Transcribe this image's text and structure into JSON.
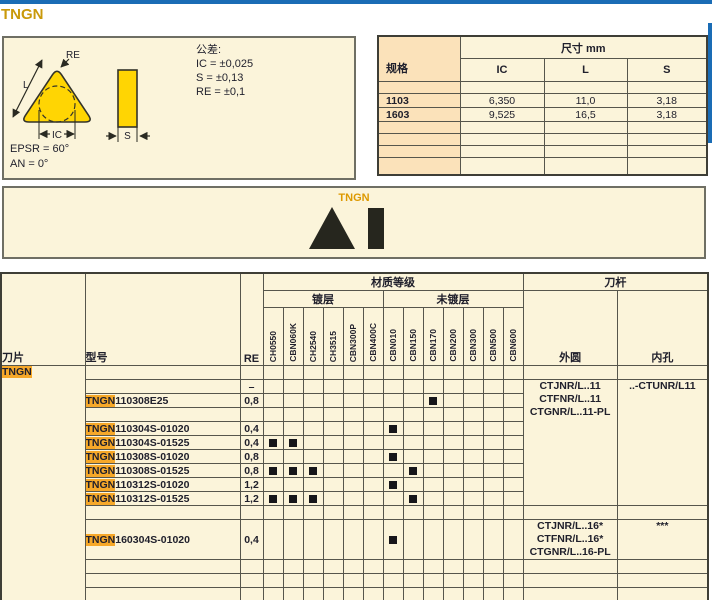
{
  "page": {
    "title": "TNGN",
    "accent_blue": "#1a6cb5",
    "cream": "#fbf4da",
    "peach": "#fbe2ba",
    "highlight_orange": "#f6a829",
    "insert_yellow": "#ffd503"
  },
  "diagram": {
    "labels": {
      "re": "RE",
      "l": "L",
      "ic": "IC",
      "s": "S"
    },
    "epsr": "EPSR = 60°",
    "an": "AN = 0°",
    "tolerance_title": "公差:",
    "tolerances": [
      "IC = ±0,025",
      "S = ±0,13",
      "RE = ±0,1"
    ]
  },
  "dims_table": {
    "spec_header": "规格",
    "size_header": "尺寸 mm",
    "columns": [
      "IC",
      "L",
      "S"
    ],
    "rows": [
      {
        "spec": "",
        "vals": [
          "",
          "",
          ""
        ]
      },
      {
        "spec": "1103",
        "vals": [
          "6,350",
          "11,0",
          "3,18"
        ]
      },
      {
        "spec": "1603",
        "vals": [
          "9,525",
          "16,5",
          "3,18"
        ]
      },
      {
        "spec": "",
        "vals": [
          "",
          "",
          ""
        ]
      },
      {
        "spec": "",
        "vals": [
          "",
          "",
          ""
        ]
      },
      {
        "spec": "",
        "vals": [
          "",
          "",
          ""
        ]
      },
      {
        "spec": "",
        "vals": [
          "",
          "",
          ""
        ]
      }
    ]
  },
  "shape_band": {
    "label": "TNGN"
  },
  "main_table": {
    "headers": {
      "blade": "刀片",
      "model": "型号",
      "re": "RE",
      "grade_group": "材质等级",
      "coated": "镀层",
      "uncoated": "未镀层",
      "holder_group": "刀杆",
      "od": "外圆",
      "id": "内孔"
    },
    "blade_label": "TNGN",
    "grade_columns": {
      "coated": [
        "CH0550",
        "CBN060K",
        "CH2540",
        "CH3515",
        "CBN300P",
        "CBN400C"
      ],
      "uncoated": [
        "CBN010",
        "CBN150",
        "CBN170",
        "CBN200",
        "CBN300",
        "CBN500",
        "CBN600"
      ]
    },
    "holder_blocks": {
      "block11": {
        "od": [
          "CTJNR/L..11",
          "CTFNR/L..11",
          "CTGNR/L..11-PL"
        ],
        "id": [
          "..-CTUNR/L11"
        ],
        "rowspan": 9
      },
      "block16": {
        "od": [
          "CTJNR/L..16*",
          "CTFNR/L..16*",
          "CTGNR/L..16-PL"
        ],
        "id": [
          "***"
        ],
        "rowspan": 1
      }
    },
    "rows": [
      {
        "model": "",
        "re": "",
        "marks": []
      },
      {
        "model": "",
        "re": "–",
        "marks": [],
        "holders": "block11"
      },
      {
        "model": "TNGN110308E25",
        "re": "0,8",
        "marks": [
          "CBN170"
        ],
        "in_merge": true
      },
      {
        "model": "",
        "re": "",
        "marks": [],
        "in_merge": true
      },
      {
        "model": "TNGN110304S-01020",
        "re": "0,4",
        "marks": [
          "CBN010"
        ],
        "in_merge": true
      },
      {
        "model": "TNGN110304S-01525",
        "re": "0,4",
        "marks": [
          "CH0550",
          "CBN060K"
        ],
        "in_merge": true
      },
      {
        "model": "TNGN110308S-01020",
        "re": "0,8",
        "marks": [
          "CBN010"
        ],
        "in_merge": true
      },
      {
        "model": "TNGN110308S-01525",
        "re": "0,8",
        "marks": [
          "CH0550",
          "CBN060K",
          "CH2540",
          "CBN150"
        ],
        "in_merge": true
      },
      {
        "model": "TNGN110312S-01020",
        "re": "1,2",
        "marks": [
          "CBN010"
        ],
        "in_merge": true
      },
      {
        "model": "TNGN110312S-01525",
        "re": "1,2",
        "marks": [
          "CH0550",
          "CBN060K",
          "CH2540",
          "CBN150"
        ],
        "in_merge": true
      },
      {
        "model": "",
        "re": "",
        "marks": []
      },
      {
        "model": "TNGN160304S-01020",
        "re": "0,4",
        "marks": [
          "CBN010"
        ],
        "holders": "block16",
        "tall": true
      },
      {
        "model": "",
        "re": "",
        "marks": []
      },
      {
        "model": "",
        "re": "",
        "marks": []
      },
      {
        "model": "",
        "re": "",
        "marks": []
      }
    ]
  }
}
